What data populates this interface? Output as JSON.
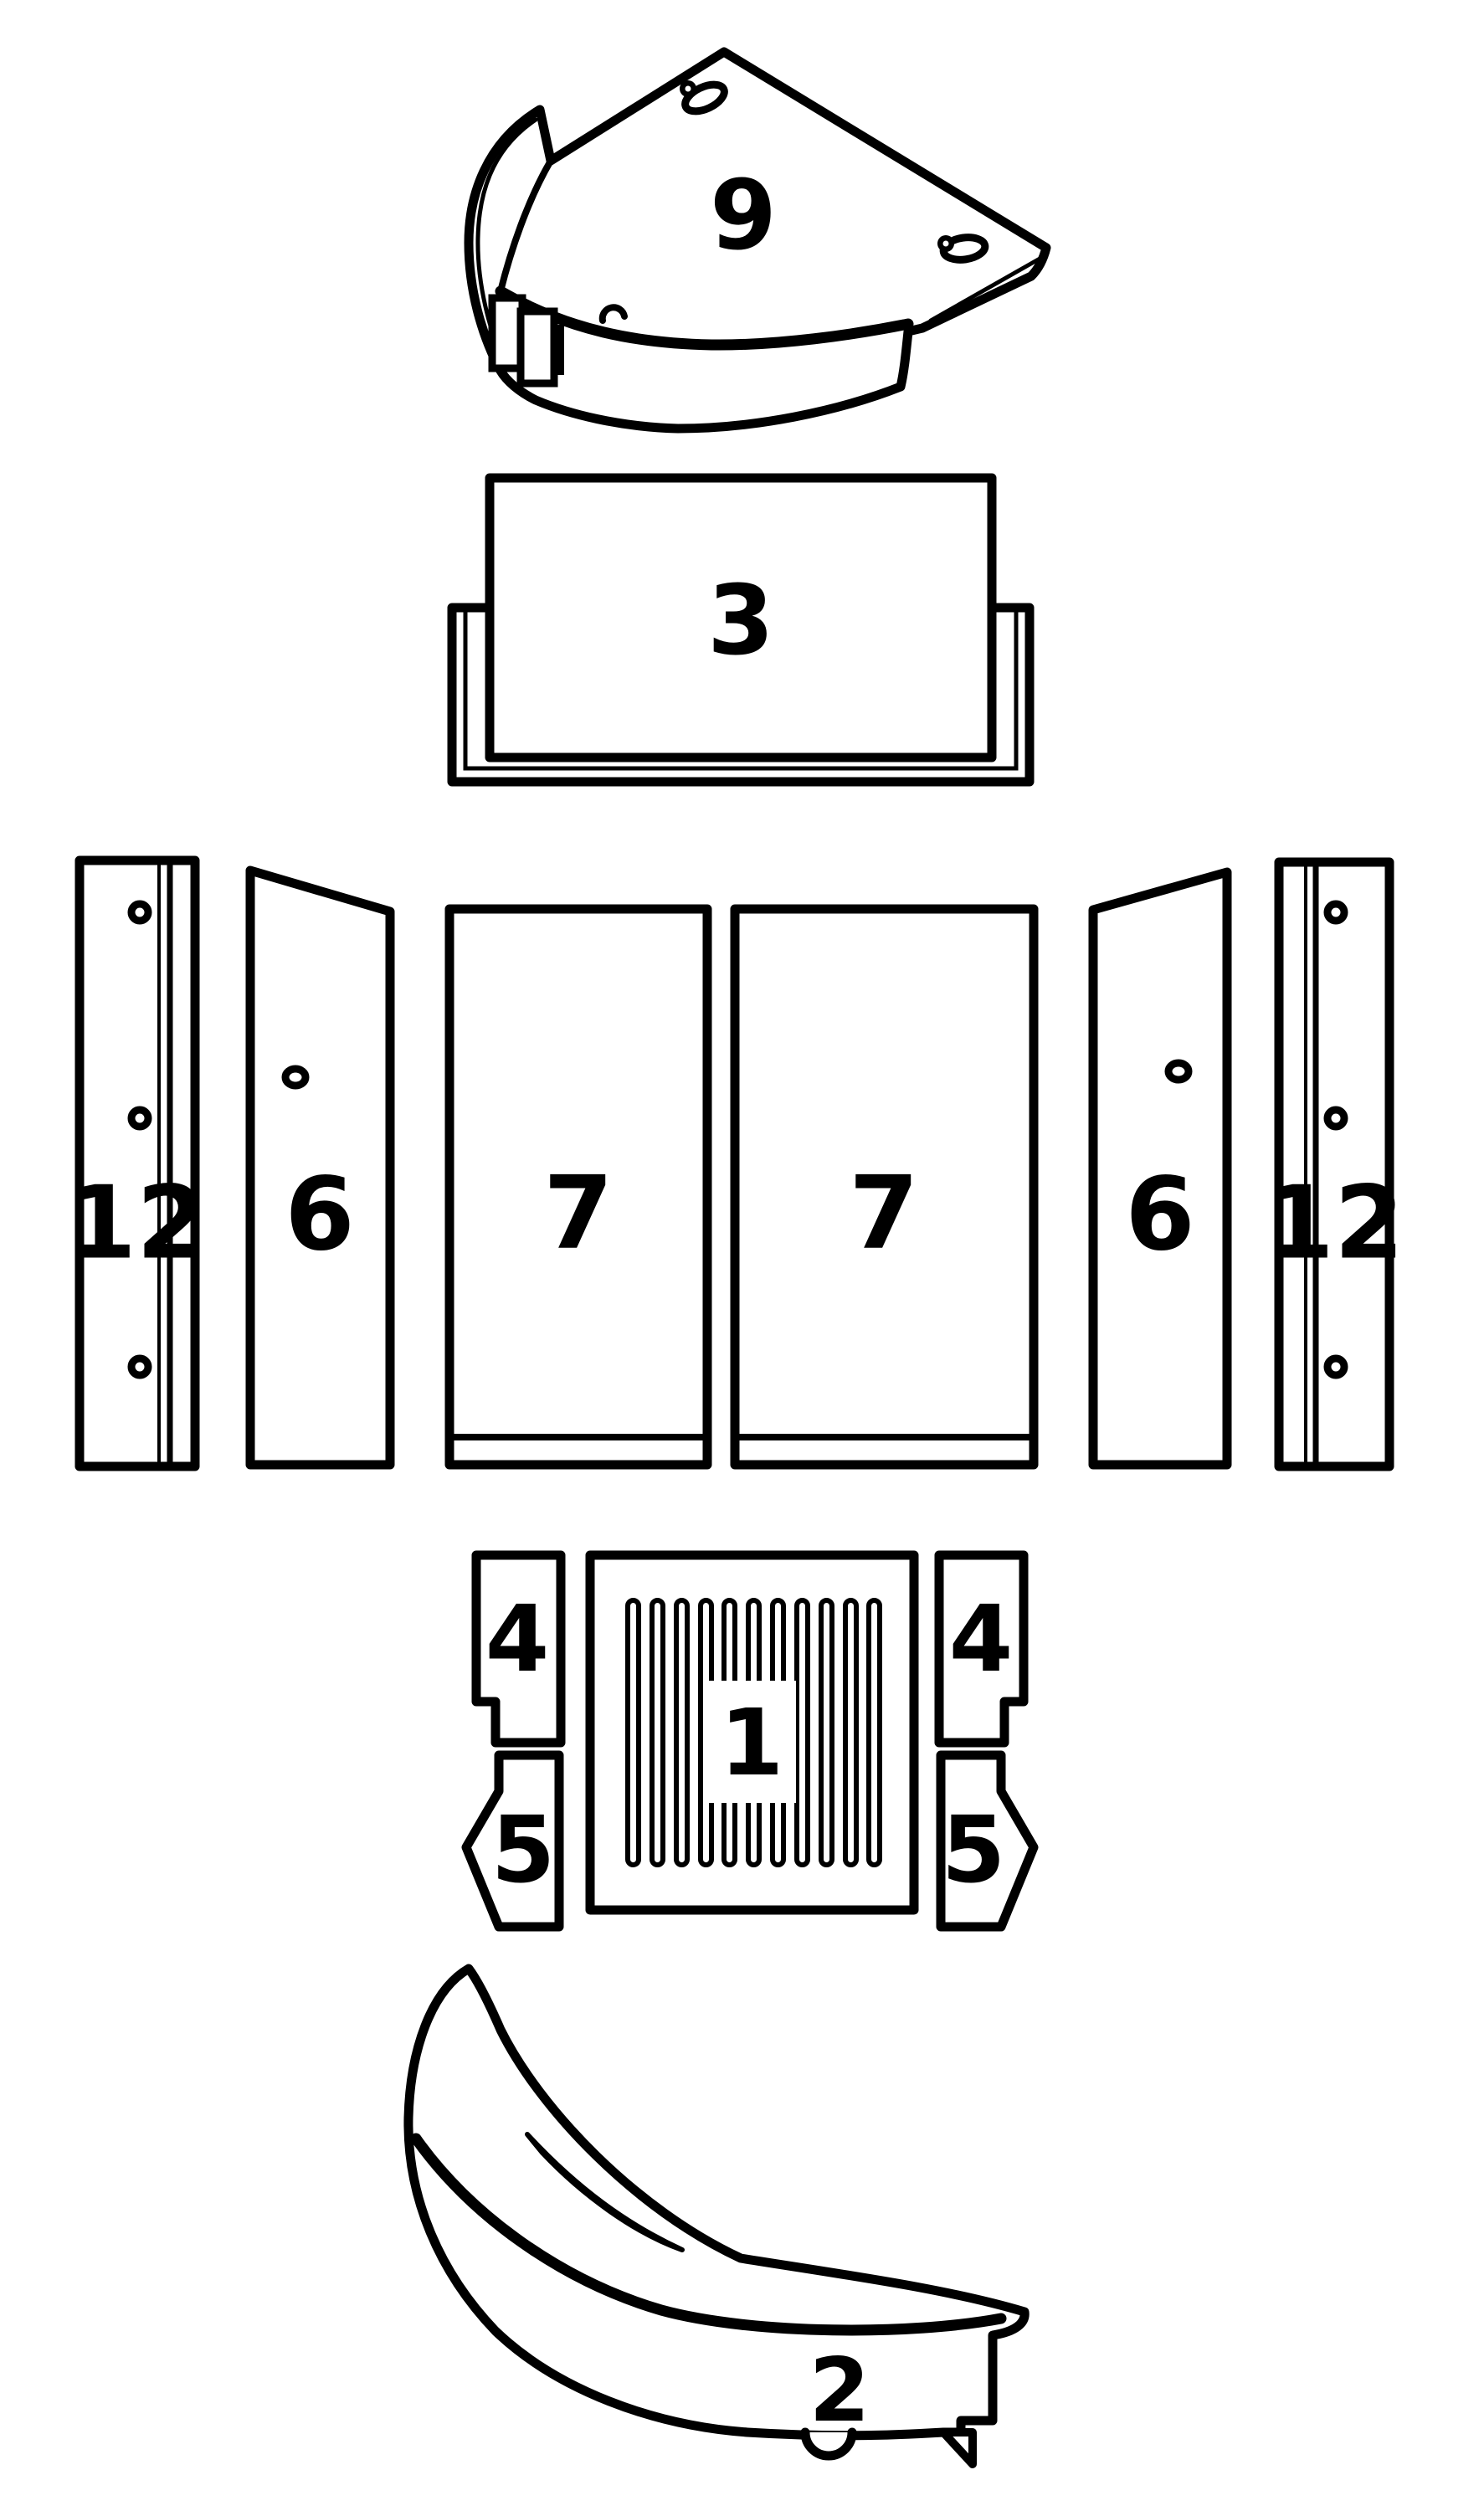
{
  "diagram": {
    "type": "exploded-parts-diagram",
    "background": "#ffffff",
    "line_color": "#000000",
    "highlight_color": "#f20d0d",
    "parts": [
      {
        "id": "part-9-baffle-plate",
        "label": "9",
        "highlighted": false
      },
      {
        "id": "part-3-back-panel",
        "label": "3",
        "highlighted": false
      },
      {
        "id": "part-12-side-liner-left",
        "label": "12",
        "highlighted": false
      },
      {
        "id": "part-6-side-liner-left",
        "label": "6",
        "highlighted": false
      },
      {
        "id": "part-7-back-liner-left",
        "label": "7",
        "highlighted": false
      },
      {
        "id": "part-7-back-liner-right",
        "label": "7",
        "highlighted": false
      },
      {
        "id": "part-6-side-liner-right",
        "label": "6",
        "highlighted": false
      },
      {
        "id": "part-12-side-liner-right",
        "label": "12",
        "highlighted": true
      },
      {
        "id": "part-4-grate-bar-left",
        "label": "4",
        "highlighted": false
      },
      {
        "id": "part-5-grate-bar-front-left",
        "label": "5",
        "highlighted": false
      },
      {
        "id": "part-1-grate",
        "label": "1",
        "highlighted": false
      },
      {
        "id": "part-4-grate-bar-right",
        "label": "4",
        "highlighted": false
      },
      {
        "id": "part-5-grate-bar-front-right",
        "label": "5",
        "highlighted": false
      },
      {
        "id": "part-2-log-retainer",
        "label": "2",
        "highlighted": false
      }
    ]
  }
}
